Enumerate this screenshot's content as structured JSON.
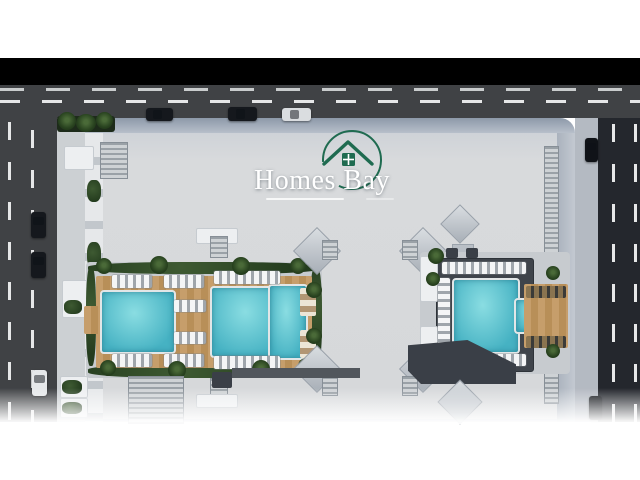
{
  "branding": {
    "logo_text": "Homes Bay"
  },
  "colors": {
    "letterbox": "#000000",
    "road": "#404245",
    "roadR": "#24272d",
    "dash": "#e6e7e8",
    "dashdim": "#c9cccd",
    "walk": "#ccd0d3",
    "walkR": "#b4bac2",
    "pool": "#46b2c3",
    "poolHi": "#8adde2",
    "darkroof": "#3a3f47",
    "logo_green": "#1f6b50",
    "logo_text": "#ffffff"
  },
  "scene": {
    "elements": [
      {
        "n": "top-road",
        "t": "road",
        "x": 0,
        "y": 85,
        "w": 640,
        "h": 33
      },
      {
        "n": "top-road-far-lane-line",
        "t": "laneHdim",
        "x": 0,
        "y": 88,
        "w": 640,
        "h": 3
      },
      {
        "n": "top-road-center-line",
        "t": "laneH",
        "x": 0,
        "y": 100,
        "w": 640,
        "h": 3
      },
      {
        "n": "left-road",
        "t": "road",
        "x": 0,
        "y": 118,
        "w": 57,
        "h": 304
      },
      {
        "n": "left-road-lane-line",
        "t": "laneV",
        "x": 8,
        "y": 122,
        "w": 3,
        "h": 300
      },
      {
        "n": "left-road-lane-line",
        "t": "laneV",
        "x": 31,
        "y": 130,
        "w": 3,
        "h": 292
      },
      {
        "n": "left-sidewalk",
        "t": "walk",
        "x": 57,
        "y": 118,
        "w": 28,
        "h": 304
      },
      {
        "n": "right-sidewalk",
        "t": "walkR",
        "x": 575,
        "y": 118,
        "w": 23,
        "h": 304
      },
      {
        "n": "right-road",
        "t": "roadR",
        "x": 598,
        "y": 118,
        "w": 42,
        "h": 304
      },
      {
        "n": "right-road-lane-line",
        "t": "laneV",
        "x": 612,
        "y": 124,
        "w": 3,
        "h": 298
      },
      {
        "n": "right-road-lane-line",
        "t": "laneV",
        "x": 634,
        "y": 124,
        "w": 3,
        "h": 298
      },
      {
        "n": "building-roof",
        "t": "roof",
        "x": 85,
        "y": 118,
        "w": 490,
        "h": 304
      },
      {
        "n": "roof-edge-band",
        "t": "band",
        "x": 85,
        "y": 118,
        "w": 490,
        "h": 15
      },
      {
        "n": "left-facade-balconies",
        "t": "facade",
        "x": 85,
        "y": 133,
        "w": 18,
        "h": 289
      },
      {
        "n": "right-facade",
        "t": "facadeR",
        "x": 557,
        "y": 133,
        "w": 18,
        "h": 289
      },
      {
        "n": "rooftop-louver-strip",
        "t": "louver",
        "x": 544,
        "y": 146,
        "w": 13,
        "h": 256
      },
      {
        "n": "roof-planter",
        "t": "planter",
        "x": 57,
        "y": 116,
        "w": 58,
        "h": 16
      },
      {
        "n": "palm-tree",
        "t": "palm",
        "x": 58,
        "y": 112,
        "w": 18,
        "h": 18
      },
      {
        "n": "palm-tree",
        "t": "palm",
        "x": 76,
        "y": 114,
        "w": 20,
        "h": 18
      },
      {
        "n": "palm-tree",
        "t": "palm",
        "x": 96,
        "y": 112,
        "w": 17,
        "h": 17
      },
      {
        "n": "roof-structure",
        "t": "white",
        "x": 64,
        "y": 146,
        "w": 28,
        "h": 22
      },
      {
        "n": "rooftop-louver",
        "t": "louver",
        "x": 100,
        "y": 142,
        "w": 26,
        "h": 35
      },
      {
        "n": "roof-terrace-green",
        "t": "green",
        "x": 87,
        "y": 180,
        "w": 14,
        "h": 22
      },
      {
        "n": "roof-terrace-green",
        "t": "green",
        "x": 87,
        "y": 242,
        "w": 14,
        "h": 26
      },
      {
        "n": "roof-terrace-green",
        "t": "green",
        "x": 87,
        "y": 306,
        "w": 14,
        "h": 22
      },
      {
        "n": "roof-structure",
        "t": "white",
        "x": 62,
        "y": 280,
        "w": 24,
        "h": 36
      },
      {
        "n": "roof-terrace-green",
        "t": "green",
        "x": 64,
        "y": 300,
        "w": 18,
        "h": 14
      },
      {
        "n": "left-courtyard",
        "t": "court",
        "x": 86,
        "y": 262,
        "w": 236,
        "h": 116
      },
      {
        "n": "hedge",
        "t": "green",
        "x": 88,
        "y": 262,
        "w": 232,
        "h": 12
      },
      {
        "n": "hedge",
        "t": "green",
        "x": 88,
        "y": 364,
        "w": 232,
        "h": 14
      },
      {
        "n": "hedge",
        "t": "green",
        "x": 86,
        "y": 266,
        "w": 10,
        "h": 100
      },
      {
        "n": "hedge",
        "t": "green",
        "x": 310,
        "y": 266,
        "w": 12,
        "h": 100
      },
      {
        "n": "pool-deck",
        "t": "wood",
        "x": 96,
        "y": 276,
        "w": 216,
        "h": 92
      },
      {
        "n": "pool-pier",
        "t": "wood",
        "x": 84,
        "y": 306,
        "w": 16,
        "h": 28
      },
      {
        "n": "swimming-pool",
        "t": "pool",
        "x": 100,
        "y": 290,
        "w": 72,
        "h": 60
      },
      {
        "n": "swimming-pool",
        "t": "pool",
        "x": 210,
        "y": 286,
        "w": 74,
        "h": 68
      },
      {
        "n": "swimming-pool",
        "t": "pool",
        "x": 268,
        "y": 284,
        "w": 36,
        "h": 72
      },
      {
        "n": "sun-loungers",
        "t": "lngH",
        "x": 112,
        "y": 275,
        "w": 40,
        "h": 13
      },
      {
        "n": "sun-loungers",
        "t": "lngH",
        "x": 164,
        "y": 275,
        "w": 40,
        "h": 13
      },
      {
        "n": "sun-loungers",
        "t": "lngH",
        "x": 214,
        "y": 271,
        "w": 66,
        "h": 13
      },
      {
        "n": "sun-loungers",
        "t": "lngH",
        "x": 214,
        "y": 356,
        "w": 66,
        "h": 13
      },
      {
        "n": "sun-loungers",
        "t": "lngH",
        "x": 112,
        "y": 354,
        "w": 40,
        "h": 13
      },
      {
        "n": "sun-loungers",
        "t": "lngH",
        "x": 164,
        "y": 354,
        "w": 40,
        "h": 13
      },
      {
        "n": "sun-loungers",
        "t": "lngH",
        "x": 174,
        "y": 300,
        "w": 32,
        "h": 12
      },
      {
        "n": "sun-loungers",
        "t": "lngH",
        "x": 174,
        "y": 332,
        "w": 32,
        "h": 12
      },
      {
        "n": "umbrella-loungers",
        "t": "umb",
        "x": 300,
        "y": 288,
        "w": 16,
        "h": 28
      },
      {
        "n": "umbrella-loungers",
        "t": "umb",
        "x": 300,
        "y": 330,
        "w": 16,
        "h": 28
      },
      {
        "n": "palm-tree",
        "t": "palm",
        "x": 96,
        "y": 258,
        "w": 16,
        "h": 16
      },
      {
        "n": "palm-tree",
        "t": "palm",
        "x": 150,
        "y": 256,
        "w": 18,
        "h": 18
      },
      {
        "n": "palm-tree",
        "t": "palm",
        "x": 232,
        "y": 257,
        "w": 18,
        "h": 18
      },
      {
        "n": "palm-tree",
        "t": "palm",
        "x": 290,
        "y": 258,
        "w": 16,
        "h": 16
      },
      {
        "n": "palm-tree",
        "t": "palm",
        "x": 100,
        "y": 360,
        "w": 16,
        "h": 16
      },
      {
        "n": "palm-tree",
        "t": "palm",
        "x": 168,
        "y": 361,
        "w": 18,
        "h": 18
      },
      {
        "n": "palm-tree",
        "t": "palm",
        "x": 252,
        "y": 360,
        "w": 18,
        "h": 18
      },
      {
        "n": "palm-tree",
        "t": "palm",
        "x": 298,
        "y": 358,
        "w": 16,
        "h": 16
      },
      {
        "n": "palm-tree",
        "t": "palm",
        "x": 306,
        "y": 282,
        "w": 16,
        "h": 16
      },
      {
        "n": "palm-tree",
        "t": "palm",
        "x": 306,
        "y": 328,
        "w": 16,
        "h": 16
      },
      {
        "n": "roof-structure",
        "t": "white",
        "x": 196,
        "y": 228,
        "w": 40,
        "h": 14
      },
      {
        "n": "rooftop-louver",
        "t": "louver",
        "x": 210,
        "y": 236,
        "w": 16,
        "h": 20
      },
      {
        "n": "rooftop-louver",
        "t": "louver",
        "x": 210,
        "y": 378,
        "w": 16,
        "h": 22
      },
      {
        "n": "roof-structure",
        "t": "white",
        "x": 196,
        "y": 394,
        "w": 40,
        "h": 12
      },
      {
        "n": "wing-tip-roof",
        "t": "diamond",
        "x": 300,
        "y": 234,
        "w": 32,
        "h": 32
      },
      {
        "n": "rooftop-louver",
        "t": "louver",
        "x": 322,
        "y": 240,
        "w": 14,
        "h": 18
      },
      {
        "n": "wing-tip-roof",
        "t": "diamond",
        "x": 300,
        "y": 352,
        "w": 32,
        "h": 32
      },
      {
        "n": "rooftop-louver",
        "t": "louver",
        "x": 322,
        "y": 376,
        "w": 14,
        "h": 18
      },
      {
        "n": "wing-tip-roof",
        "t": "diamond",
        "x": 406,
        "y": 234,
        "w": 32,
        "h": 32
      },
      {
        "n": "rooftop-louver",
        "t": "louver",
        "x": 402,
        "y": 240,
        "w": 14,
        "h": 18
      },
      {
        "n": "wing-tip-roof",
        "t": "diamond",
        "x": 406,
        "y": 352,
        "w": 32,
        "h": 32
      },
      {
        "n": "rooftop-louver",
        "t": "louver",
        "x": 402,
        "y": 376,
        "w": 14,
        "h": 18
      },
      {
        "n": "wing-tip-roof",
        "t": "diamond",
        "x": 446,
        "y": 210,
        "w": 26,
        "h": 26
      },
      {
        "n": "roof-structure",
        "t": "grayb",
        "x": 452,
        "y": 244,
        "w": 20,
        "h": 12
      },
      {
        "n": "right-courtyard",
        "t": "court",
        "x": 420,
        "y": 252,
        "w": 150,
        "h": 122
      },
      {
        "n": "pool-deck",
        "t": "deckdark",
        "x": 436,
        "y": 258,
        "w": 96,
        "h": 112
      },
      {
        "n": "swimming-pool",
        "t": "pool",
        "x": 452,
        "y": 278,
        "w": 64,
        "h": 72
      },
      {
        "n": "swimming-pool",
        "t": "pool",
        "x": 514,
        "y": 298,
        "w": 34,
        "h": 32
      },
      {
        "n": "pool-deck",
        "t": "wood",
        "x": 524,
        "y": 284,
        "w": 44,
        "h": 64
      },
      {
        "n": "roof-structure",
        "t": "white",
        "x": 420,
        "y": 256,
        "w": 16,
        "h": 44
      },
      {
        "n": "roof-structure",
        "t": "white",
        "x": 420,
        "y": 326,
        "w": 16,
        "h": 44
      },
      {
        "n": "sun-loungers",
        "t": "lngH",
        "x": 442,
        "y": 262,
        "w": 84,
        "h": 12
      },
      {
        "n": "sun-loungers",
        "t": "lngH",
        "x": 442,
        "y": 354,
        "w": 84,
        "h": 12
      },
      {
        "n": "sun-loungers",
        "t": "lngV",
        "x": 438,
        "y": 278,
        "w": 12,
        "h": 72
      },
      {
        "n": "sun-loungers",
        "t": "lngDark",
        "x": 526,
        "y": 286,
        "w": 40,
        "h": 12
      },
      {
        "n": "sun-loungers",
        "t": "lngDark",
        "x": 526,
        "y": 336,
        "w": 40,
        "h": 12
      },
      {
        "n": "palm-tree",
        "t": "palm",
        "x": 428,
        "y": 248,
        "w": 16,
        "h": 16
      },
      {
        "n": "palm-tree",
        "t": "palm",
        "x": 426,
        "y": 272,
        "w": 14,
        "h": 14
      },
      {
        "n": "palm-tree",
        "t": "palm",
        "x": 546,
        "y": 266,
        "w": 14,
        "h": 14
      },
      {
        "n": "palm-tree",
        "t": "palm",
        "x": 546,
        "y": 344,
        "w": 14,
        "h": 14
      },
      {
        "n": "roof-structure",
        "t": "darkroof",
        "x": 446,
        "y": 248,
        "w": 12,
        "h": 10
      },
      {
        "n": "roof-structure",
        "t": "darkroof",
        "x": 466,
        "y": 248,
        "w": 12,
        "h": 10
      },
      {
        "n": "roof-strip",
        "t": "strip",
        "x": 232,
        "y": 368,
        "w": 128,
        "h": 10
      },
      {
        "n": "roof-structure",
        "t": "darkroofBig",
        "x": 408,
        "y": 340,
        "w": 108,
        "h": 44
      },
      {
        "n": "wing-tip-roof",
        "t": "diamond",
        "x": 444,
        "y": 386,
        "w": 30,
        "h": 30
      },
      {
        "n": "rooftop-louver",
        "t": "louver",
        "x": 128,
        "y": 376,
        "w": 54,
        "h": 46
      },
      {
        "n": "roof-structure",
        "t": "white",
        "x": 60,
        "y": 376,
        "w": 26,
        "h": 20
      },
      {
        "n": "roof-terrace-green",
        "t": "green",
        "x": 62,
        "y": 380,
        "w": 20,
        "h": 14
      },
      {
        "n": "roof-structure",
        "t": "white",
        "x": 60,
        "y": 398,
        "w": 26,
        "h": 18
      },
      {
        "n": "roof-terrace-green",
        "t": "green",
        "x": 62,
        "y": 402,
        "w": 20,
        "h": 12
      },
      {
        "n": "roof-structure",
        "t": "darkroof",
        "x": 212,
        "y": 372,
        "w": 20,
        "h": 16
      },
      {
        "n": "car",
        "t": "carH",
        "x": 146,
        "y": 108,
        "w": 27,
        "h": 13,
        "bg": "#15181d"
      },
      {
        "n": "car",
        "t": "carH",
        "x": 228,
        "y": 107,
        "w": 29,
        "h": 14,
        "bg": "#15181d"
      },
      {
        "n": "car",
        "t": "carH",
        "x": 282,
        "y": 108,
        "w": 29,
        "h": 13,
        "bg": "#dadde0"
      },
      {
        "n": "car",
        "t": "carV",
        "x": 31,
        "y": 212,
        "w": 15,
        "h": 26,
        "bg": "#15181d"
      },
      {
        "n": "car",
        "t": "carV",
        "x": 31,
        "y": 252,
        "w": 15,
        "h": 26,
        "bg": "#15181d"
      },
      {
        "n": "car",
        "t": "carV",
        "x": 32,
        "y": 370,
        "w": 15,
        "h": 26,
        "bg": "#e6e8ea"
      },
      {
        "n": "car",
        "t": "carV",
        "x": 585,
        "y": 138,
        "w": 13,
        "h": 24,
        "bg": "#101318"
      },
      {
        "n": "car",
        "t": "carV",
        "x": 589,
        "y": 396,
        "w": 13,
        "h": 24,
        "bg": "#101318"
      }
    ]
  }
}
